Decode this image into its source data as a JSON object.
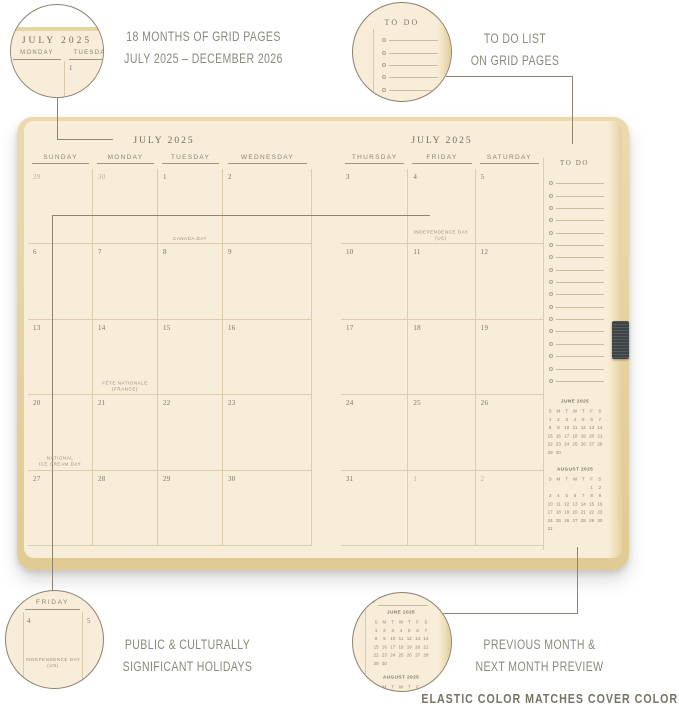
{
  "colors": {
    "page_cream": "#f8edd8",
    "cover_tan": "#e8d5a5",
    "grid_line": "#ddcdab",
    "elastic_dark": "#3e4345",
    "connector": "#8f8473",
    "caption_text": "#8e8879"
  },
  "callouts": {
    "grid_pages": {
      "line1": "18 MONTHS OF GRID PAGES",
      "line2": "JULY 2025 – DECEMBER 2026"
    },
    "todo": {
      "line1": "TO DO LIST",
      "line2": "ON GRID PAGES"
    },
    "holidays": {
      "line1": "PUBLIC & CULTURALLY",
      "line2": "SIGNIFICANT HOLIDAYS"
    },
    "preview": {
      "line1": "PREVIOUS MONTH &",
      "line2": "NEXT MONTH PREVIEW"
    },
    "footer": "ELASTIC COLOR MATCHES COVER COLOR"
  },
  "detail_circles": {
    "grid_pages": {
      "title": "JULY 2025",
      "headers": [
        "MONDAY",
        "TUESDAY"
      ],
      "day": "1"
    },
    "todo": {
      "title": "TO DO",
      "rows": 7
    },
    "holidays": {
      "header": "FRIDAY",
      "day_left": "4",
      "day_right": "5",
      "holiday_lines": [
        "INDEPENDENCE DAY",
        "(US)"
      ]
    }
  },
  "planner": {
    "left_page": {
      "title": "JULY 2025",
      "day_headers": [
        "SUNDAY",
        "MONDAY",
        "TUESDAY",
        "WEDNESDAY"
      ],
      "weeks": [
        [
          {
            "n": "29",
            "muted": true
          },
          {
            "n": "30",
            "muted": true
          },
          {
            "n": "1",
            "holiday": [
              "CANADA DAY"
            ]
          },
          {
            "n": "2"
          }
        ],
        [
          {
            "n": "6"
          },
          {
            "n": "7"
          },
          {
            "n": "8"
          },
          {
            "n": "9"
          }
        ],
        [
          {
            "n": "13"
          },
          {
            "n": "14",
            "holiday": [
              "FÊTE NATIONALE",
              "(FRANCE)"
            ]
          },
          {
            "n": "15"
          },
          {
            "n": "16"
          }
        ],
        [
          {
            "n": "20",
            "holiday": [
              "NATIONAL",
              "ICE CREAM DAY"
            ]
          },
          {
            "n": "21"
          },
          {
            "n": "22"
          },
          {
            "n": "23"
          }
        ],
        [
          {
            "n": "27"
          },
          {
            "n": "28"
          },
          {
            "n": "29"
          },
          {
            "n": "30"
          }
        ]
      ]
    },
    "right_page": {
      "title": "JULY 2025",
      "day_headers": [
        "THURSDAY",
        "FRIDAY",
        "SATURDAY"
      ],
      "weeks": [
        [
          {
            "n": "3"
          },
          {
            "n": "4",
            "holiday": [
              "INDEPENDENCE DAY",
              "(US)"
            ]
          },
          {
            "n": "5"
          }
        ],
        [
          {
            "n": "10"
          },
          {
            "n": "11"
          },
          {
            "n": "12"
          }
        ],
        [
          {
            "n": "17"
          },
          {
            "n": "18"
          },
          {
            "n": "19"
          }
        ],
        [
          {
            "n": "24"
          },
          {
            "n": "25"
          },
          {
            "n": "26"
          }
        ],
        [
          {
            "n": "31"
          },
          {
            "n": "1",
            "muted": true
          },
          {
            "n": "2",
            "muted": true
          }
        ]
      ],
      "todo": {
        "header": "TO DO",
        "rows": 17
      },
      "mini_calendars": [
        {
          "title": "JUNE 2025",
          "dow": [
            "S",
            "M",
            "T",
            "W",
            "T",
            "F",
            "S"
          ],
          "weeks": [
            [
              "1",
              "2",
              "3",
              "4",
              "5",
              "6",
              "7"
            ],
            [
              "8",
              "9",
              "10",
              "11",
              "12",
              "13",
              "14"
            ],
            [
              "15",
              "16",
              "17",
              "18",
              "19",
              "20",
              "21"
            ],
            [
              "22",
              "23",
              "24",
              "25",
              "26",
              "27",
              "28"
            ],
            [
              "29",
              "30",
              "",
              "",
              "",
              "",
              ""
            ]
          ]
        },
        {
          "title": "AUGUST 2025",
          "dow": [
            "S",
            "M",
            "T",
            "W",
            "T",
            "F",
            "S"
          ],
          "weeks": [
            [
              "",
              "",
              "",
              "",
              "",
              "1",
              "2"
            ],
            [
              "3",
              "4",
              "5",
              "6",
              "7",
              "8",
              "9"
            ],
            [
              "10",
              "11",
              "12",
              "13",
              "14",
              "15",
              "16"
            ],
            [
              "17",
              "18",
              "19",
              "20",
              "21",
              "22",
              "23"
            ],
            [
              "24",
              "25",
              "26",
              "27",
              "28",
              "29",
              "30"
            ],
            [
              "31",
              "",
              "",
              "",
              "",
              "",
              ""
            ]
          ]
        }
      ]
    }
  }
}
